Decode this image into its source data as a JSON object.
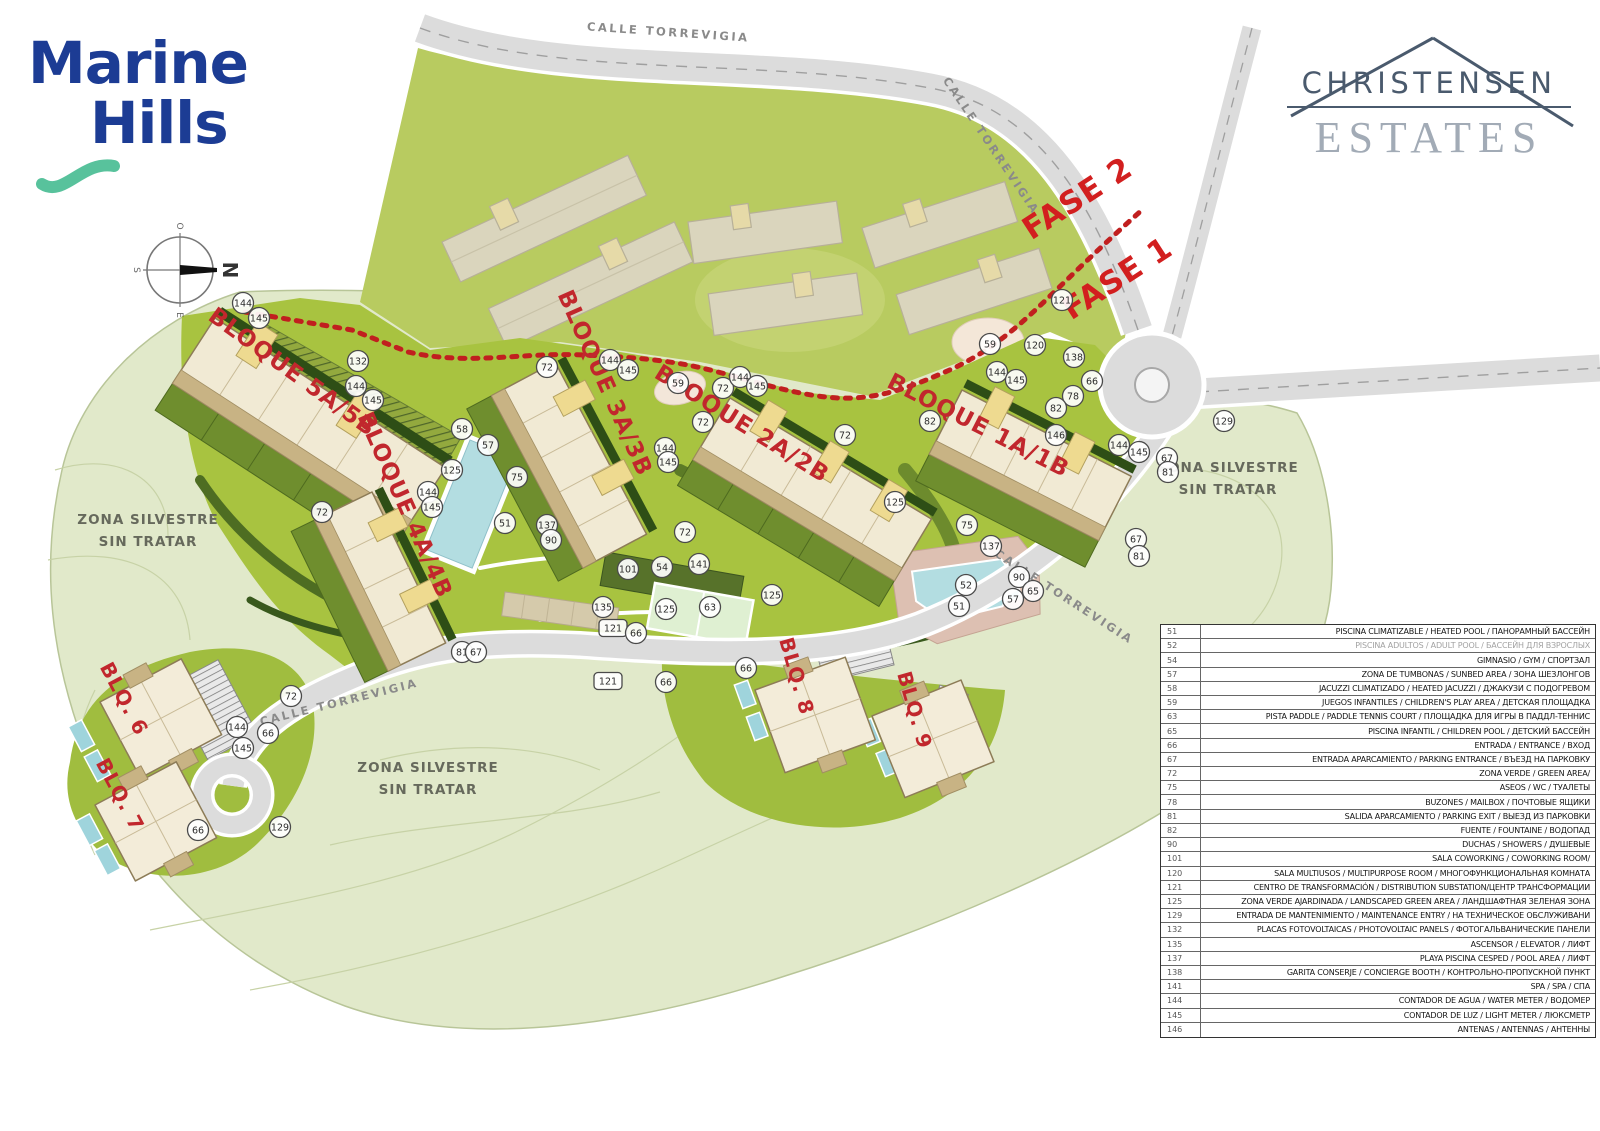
{
  "branding": {
    "marine_hills": {
      "line1": "Marine",
      "line2": "Hills",
      "blue": "#1c3c94",
      "teal": "#58c29c"
    },
    "christensen": {
      "line1": "CHRISTENSEN",
      "line2": "ESTATES",
      "dark": "#4a5a6d",
      "light": "#a2abb6"
    }
  },
  "compass": {
    "north": "N",
    "south": "S",
    "east": "E",
    "west": "O"
  },
  "map": {
    "colors": {
      "wild": "#e1e9ca",
      "field": "#b8cb60",
      "grass": "#a8c340",
      "road": "#dcdcdc",
      "building": "#f1ead4",
      "pool": "#b3dde1",
      "red_line": "#c11f1f",
      "label_red": "#c1272d"
    },
    "fase_labels": [
      {
        "text": "FASE 2",
        "x": 1083,
        "y": 207,
        "rot": -33
      },
      {
        "text": "FASE 1",
        "x": 1123,
        "y": 287,
        "rot": -33
      }
    ],
    "road_labels": [
      {
        "text": "CALLE TORREVIGIA",
        "x": 668,
        "y": 36,
        "rot": 4
      },
      {
        "text": "CALLE TORREVIGIA",
        "x": 988,
        "y": 148,
        "rot": 56
      },
      {
        "text": "CALLE TORREVIGIA",
        "x": 1062,
        "y": 600,
        "rot": 33
      },
      {
        "text": "CALLE TORREVIGIA",
        "x": 340,
        "y": 706,
        "rot": -14
      }
    ],
    "zone_labels": [
      {
        "line1": "ZONA SILVESTRE",
        "line2": "SIN TRATAR",
        "x": 148,
        "y": 524
      },
      {
        "line1": "ZONA SILVESTRE",
        "line2": "SIN TRATAR",
        "x": 428,
        "y": 772
      },
      {
        "line1": "ZONA SILVESTRE",
        "line2": "SIN TRATAR",
        "x": 1228,
        "y": 472
      }
    ],
    "building_labels": [
      {
        "text": "BLOQUE 5A/5B",
        "x": 288,
        "y": 378,
        "rot": 36,
        "size": 23
      },
      {
        "text": "BLOQUE 3A/3B",
        "x": 598,
        "y": 386,
        "rot": 66,
        "size": 23
      },
      {
        "text": "BLOQUE 2A/2B",
        "x": 738,
        "y": 430,
        "rot": 32,
        "size": 23
      },
      {
        "text": "BLOQUE 1A/1B",
        "x": 975,
        "y": 432,
        "rot": 27,
        "size": 23
      },
      {
        "text": "BLOQUE 4A/4B",
        "x": 398,
        "y": 508,
        "rot": 66,
        "size": 23
      },
      {
        "text": "BLQ. 6",
        "x": 118,
        "y": 702,
        "rot": 62,
        "size": 20
      },
      {
        "text": "BLQ. 7",
        "x": 114,
        "y": 798,
        "rot": 62,
        "size": 20
      },
      {
        "text": "BLQ. 8",
        "x": 790,
        "y": 678,
        "rot": 74,
        "size": 20
      },
      {
        "text": "BLQ. 9",
        "x": 908,
        "y": 712,
        "rot": 74,
        "size": 20
      }
    ],
    "markers": [
      {
        "n": "144",
        "x": 243,
        "y": 303
      },
      {
        "n": "145",
        "x": 259,
        "y": 318
      },
      {
        "n": "132",
        "x": 358,
        "y": 361
      },
      {
        "n": "144",
        "x": 356,
        "y": 386
      },
      {
        "n": "145",
        "x": 373,
        "y": 400
      },
      {
        "n": "72",
        "x": 322,
        "y": 512
      },
      {
        "n": "144",
        "x": 428,
        "y": 492
      },
      {
        "n": "145",
        "x": 432,
        "y": 507
      },
      {
        "n": "58",
        "x": 462,
        "y": 429
      },
      {
        "n": "57",
        "x": 488,
        "y": 445
      },
      {
        "n": "125",
        "x": 452,
        "y": 470
      },
      {
        "n": "75",
        "x": 517,
        "y": 477
      },
      {
        "n": "51",
        "x": 505,
        "y": 523
      },
      {
        "n": "137",
        "x": 547,
        "y": 525
      },
      {
        "n": "90",
        "x": 551,
        "y": 540
      },
      {
        "n": "72",
        "x": 547,
        "y": 367
      },
      {
        "n": "144",
        "x": 610,
        "y": 360
      },
      {
        "n": "145",
        "x": 628,
        "y": 370
      },
      {
        "n": "59",
        "x": 678,
        "y": 383
      },
      {
        "n": "72",
        "x": 723,
        "y": 388
      },
      {
        "n": "144",
        "x": 740,
        "y": 377
      },
      {
        "n": "145",
        "x": 757,
        "y": 386
      },
      {
        "n": "72",
        "x": 703,
        "y": 422
      },
      {
        "n": "144",
        "x": 665,
        "y": 448
      },
      {
        "n": "145",
        "x": 668,
        "y": 462
      },
      {
        "n": "101",
        "x": 628,
        "y": 569
      },
      {
        "n": "54",
        "x": 662,
        "y": 567
      },
      {
        "n": "141",
        "x": 699,
        "y": 564
      },
      {
        "n": "72",
        "x": 685,
        "y": 532
      },
      {
        "n": "135",
        "x": 603,
        "y": 607
      },
      {
        "n": "121",
        "x": 613,
        "y": 628,
        "pill": true
      },
      {
        "n": "66",
        "x": 636,
        "y": 633
      },
      {
        "n": "121",
        "x": 608,
        "y": 681,
        "pill": true
      },
      {
        "n": "66",
        "x": 666,
        "y": 682
      },
      {
        "n": "125",
        "x": 666,
        "y": 609
      },
      {
        "n": "63",
        "x": 710,
        "y": 607
      },
      {
        "n": "125",
        "x": 772,
        "y": 595
      },
      {
        "n": "72",
        "x": 845,
        "y": 435
      },
      {
        "n": "82",
        "x": 930,
        "y": 421
      },
      {
        "n": "125",
        "x": 895,
        "y": 502
      },
      {
        "n": "75",
        "x": 967,
        "y": 525
      },
      {
        "n": "137",
        "x": 991,
        "y": 546
      },
      {
        "n": "52",
        "x": 966,
        "y": 585
      },
      {
        "n": "51",
        "x": 959,
        "y": 606
      },
      {
        "n": "90",
        "x": 1019,
        "y": 577
      },
      {
        "n": "65",
        "x": 1033,
        "y": 591
      },
      {
        "n": "57",
        "x": 1013,
        "y": 599
      },
      {
        "n": "59",
        "x": 990,
        "y": 344
      },
      {
        "n": "120",
        "x": 1035,
        "y": 345
      },
      {
        "n": "138",
        "x": 1074,
        "y": 357
      },
      {
        "n": "66",
        "x": 1092,
        "y": 381
      },
      {
        "n": "78",
        "x": 1073,
        "y": 396
      },
      {
        "n": "82",
        "x": 1056,
        "y": 408
      },
      {
        "n": "146",
        "x": 1056,
        "y": 435
      },
      {
        "n": "144",
        "x": 997,
        "y": 372
      },
      {
        "n": "145",
        "x": 1016,
        "y": 380
      },
      {
        "n": "144",
        "x": 1119,
        "y": 445
      },
      {
        "n": "145",
        "x": 1139,
        "y": 452
      },
      {
        "n": "67",
        "x": 1167,
        "y": 458
      },
      {
        "n": "81",
        "x": 1168,
        "y": 472
      },
      {
        "n": "129",
        "x": 1224,
        "y": 421
      },
      {
        "n": "67",
        "x": 1136,
        "y": 539
      },
      {
        "n": "81",
        "x": 1139,
        "y": 556
      },
      {
        "n": "121",
        "x": 1062,
        "y": 300
      },
      {
        "n": "81",
        "x": 462,
        "y": 652
      },
      {
        "n": "67",
        "x": 476,
        "y": 652
      },
      {
        "n": "72",
        "x": 291,
        "y": 696
      },
      {
        "n": "144",
        "x": 237,
        "y": 727
      },
      {
        "n": "145",
        "x": 243,
        "y": 748
      },
      {
        "n": "66",
        "x": 268,
        "y": 733
      },
      {
        "n": "66",
        "x": 198,
        "y": 830
      },
      {
        "n": "129",
        "x": 280,
        "y": 827
      },
      {
        "n": "66",
        "x": 746,
        "y": 668
      }
    ]
  },
  "legend": {
    "rows": [
      {
        "num": "51",
        "text": "PISCINA CLIMATIZABLE / HEATED POOL / ПАНОРАМНЫЙ БАССЕЙН"
      },
      {
        "num": "52",
        "text": "PISCINA ADULTOS / ADULT POOL / БАССЕЙН ДЛЯ ВЗРОСЛЫХ",
        "muted": true
      },
      {
        "num": "54",
        "text": "GIMNASIO / GYM / СПОРТЗАЛ"
      },
      {
        "num": "57",
        "text": "ZONA DE TUMBONAS / SUNBED AREA / ЗОНА ШЕЗЛОНГОВ"
      },
      {
        "num": "58",
        "text": "JACUZZI CLIMATIZADO / HEATED JACUZZI / ДЖАКУЗИ С ПОДОГРЕВОМ"
      },
      {
        "num": "59",
        "text": "JUEGOS INFANTILES / CHILDREN'S PLAY AREA / ДЕТСКАЯ ПЛОЩАДКА"
      },
      {
        "num": "63",
        "text": "PISTA PADDLE / PADDLE TENNIS COURT / ПЛОЩАДКА ДЛЯ ИГРЫ В ПАДДЛ-ТЕННИС"
      },
      {
        "num": "65",
        "text": "PISCINA INFANTIL / CHILDREN POOL / ДЕТСКИЙ БАССЕЙН"
      },
      {
        "num": "66",
        "text": "ENTRADA / ENTRANCE / ВХОД"
      },
      {
        "num": "67",
        "text": "ENTRADA APARCAMIENTO / PARKING ENTRANCE / ВЪЕЗД НА ПАРКОВКУ"
      },
      {
        "num": "72",
        "text": "ZONA VERDE / GREEN AREA/"
      },
      {
        "num": "75",
        "text": "ASEOS / WC / ТУАЛЕТЫ"
      },
      {
        "num": "78",
        "text": "BUZONES / MAILBOX / ПОЧТОВЫЕ ЯЩИКИ"
      },
      {
        "num": "81",
        "text": "SALIDA APARCAMIENTO / PARKING EXIT / ВЫЕЗД ИЗ ПАРКОВКИ"
      },
      {
        "num": "82",
        "text": "FUENTE / FOUNTAINE / ВОДОПАД"
      },
      {
        "num": "90",
        "text": "DUCHAS / SHOWERS / ДУШЕВЫЕ"
      },
      {
        "num": "101",
        "text": "SALA COWORKING / COWORKING ROOM/"
      },
      {
        "num": "120",
        "text": "SALA MULTIUSOS / MULTIPURPOSE ROOM / МНОГОФУНКЦИОНАЛЬНАЯ КОМНАТА"
      },
      {
        "num": "121",
        "text": "CENTRO DE TRANSFORMACIÓN / DISTRIBUTION SUBSTATION/ЦЕНТР ТРАНСФОРМАЦИИ"
      },
      {
        "num": "125",
        "text": "ZONA VERDE AJARDINADA / LANDSCAPED GREEN AREA / ЛАНДШАФТНАЯ ЗЕЛЕНАЯ ЗОНА"
      },
      {
        "num": "129",
        "text": "ENTRADA DE MANTENIMIENTO / MAINTENANCE ENTRY / НА ТЕХНИЧЕСКОЕ ОБСЛУЖИВАНИ"
      },
      {
        "num": "132",
        "text": "PLACAS FOTOVOLTAICAS / PHOTOVOLTAIC PANELS / ФОТОГАЛЬВАНИЧЕСКИЕ ПАНЕЛИ"
      },
      {
        "num": "135",
        "text": "ASCENSOR / ELEVATOR / ЛИФТ"
      },
      {
        "num": "137",
        "text": "PLAYA PISCINA CESPED / POOL AREA / ЛИФТ"
      },
      {
        "num": "138",
        "text": "GARITA CONSERJE / CONCIERGE BOOTH / КОНТРОЛЬНО-ПРОПУСКНОЙ ПУНКТ"
      },
      {
        "num": "141",
        "text": "SPA / SPA / СПА"
      },
      {
        "num": "144",
        "text": "CONTADOR DE AGUA / WATER METER / ВОДОМЕР"
      },
      {
        "num": "145",
        "text": "CONTADOR DE LUZ / LIGHT METER / ЛЮКСМЕТР"
      },
      {
        "num": "146",
        "text": "ANTENAS / ANTENNAS / АНТЕННЫ"
      }
    ]
  }
}
